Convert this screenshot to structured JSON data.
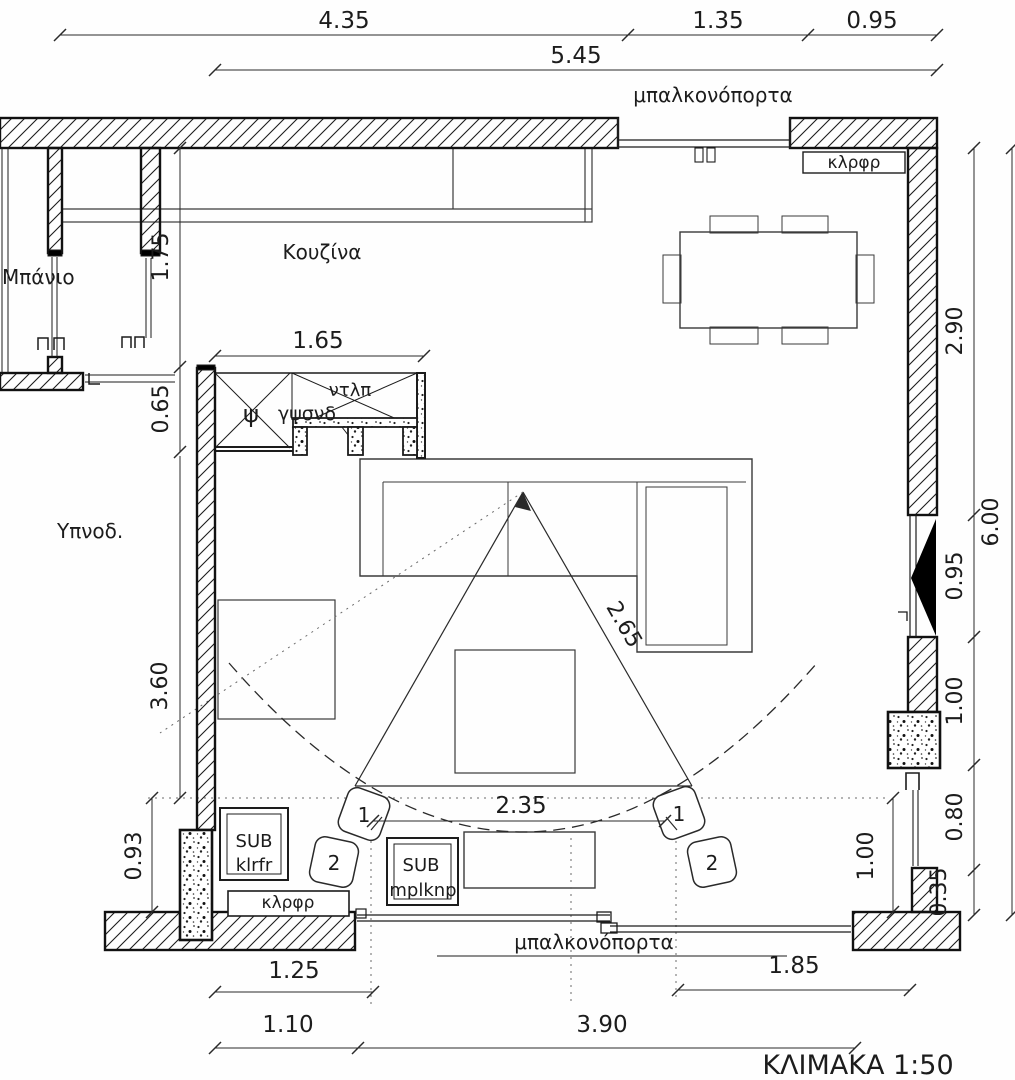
{
  "title": {
    "scale_label": "ΚΛΙΜΑΚΑ 1:50"
  },
  "rooms": {
    "kitchen": "Κουζίνα",
    "bathroom": "Μπάνιο",
    "bedroom": "Υπνοδ."
  },
  "doors": {
    "top_balcony": "μπαλκονόπορτα",
    "bottom_balcony": "μπαλκονόπορτα"
  },
  "labels": {
    "closet_top_right": "κλρφρ",
    "closet_bottom_left": "κλρφρ",
    "wardrobe": "ντλπ",
    "psi": "ψ",
    "plasterboard": "γψσνδ"
  },
  "speakers": {
    "sub_left_line1": "SUB",
    "sub_left_line2": "klrfr",
    "sub_center_line1": "SUB",
    "sub_center_line2": "mplknp",
    "front_label": "1",
    "surround_label": "2"
  },
  "dimensions": {
    "top": [
      "4.35",
      "1.35",
      "0.95"
    ],
    "top_overall": "5.45",
    "right": [
      "2.90",
      "0.95",
      "1.00",
      "0.80",
      "0.35"
    ],
    "right_overall": "6.00",
    "left": [
      "1.75",
      "0.65",
      "3.60",
      "0.93"
    ],
    "closet_width": "1.65",
    "listening_radius": "2.65",
    "listening_width": "2.35",
    "interior_right": "1.00",
    "bottom_row1": [
      "1.25",
      "1.85"
    ],
    "bottom_row2": [
      "1.10",
      "3.90"
    ]
  },
  "colors": {
    "line": "#1c1c1c",
    "furniture": "#3a3a3a",
    "dotted": "#6a6a6a",
    "paper": "#fefefe"
  }
}
